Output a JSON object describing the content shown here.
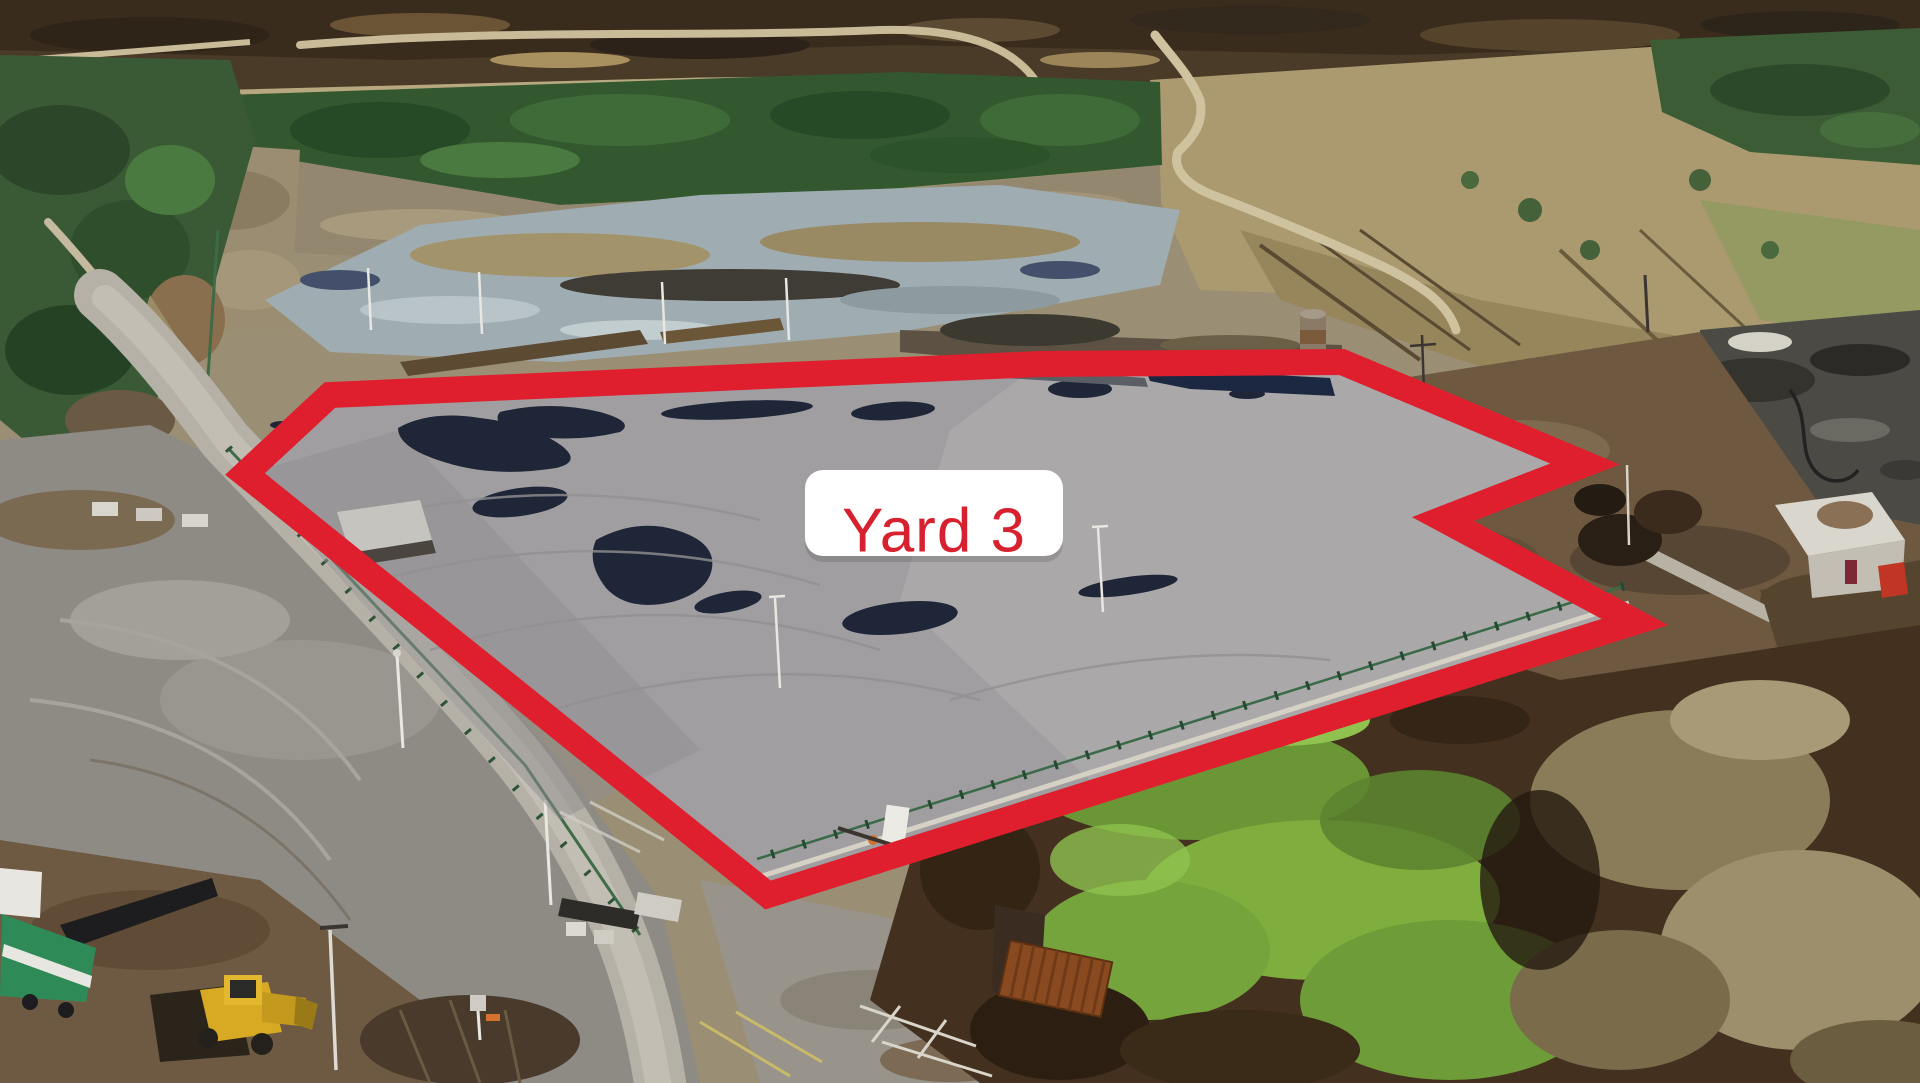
{
  "annotation": {
    "label": "Yard 3",
    "label_text_color": "#d7212e",
    "label_bg_color": "#ffffff",
    "outline_color": "#df1f2d",
    "outline_stroke_px": 26,
    "outline_points": "245,474 330,395 1040,364 1342,362 1585,464 1443,519 1635,622 768,895"
  },
  "scene": {
    "description": "Aerial drone photograph of an industrial peat-works site; a large grey tarmac yard is outlined in red and labelled",
    "features": [
      "grey tarmac yard with dark wet patches",
      "green boundary fence with kerb",
      "light gravel access road along west fence",
      "old weathered concrete pad with scrub rows",
      "conifer and bare birch forest belt",
      "dark peat bog with winding pale track",
      "tan rough fields with drainage lines",
      "dark scrap / wet hardstanding area",
      "white shed with dark red door",
      "rusted cylindrical silo tower",
      "dark compost heaps",
      "green-mossed soil mound over dark earth",
      "rust-brown container",
      "yellow wheel loader with shadow",
      "green-and-white screening machine",
      "weighbridge, barrier arm and faded road markings",
      "white light poles and floodlights"
    ],
    "palette": {
      "yard_grey": "#a09ea0",
      "wet_patch_navy": "#1f2637",
      "road_light": "#b5b1a7",
      "forest_green": "#33572f",
      "birch_tan": "#93886f",
      "bog_brown": "#4a3a28",
      "field_tan": "#ab9a6f",
      "dirt_brown": "#6e5940",
      "mound_green": "#7fae3f",
      "mound_soil": "#43301f",
      "machine_yellow": "#d8a922",
      "machine_green": "#2e8b57",
      "container_rust": "#8a4a20"
    }
  }
}
